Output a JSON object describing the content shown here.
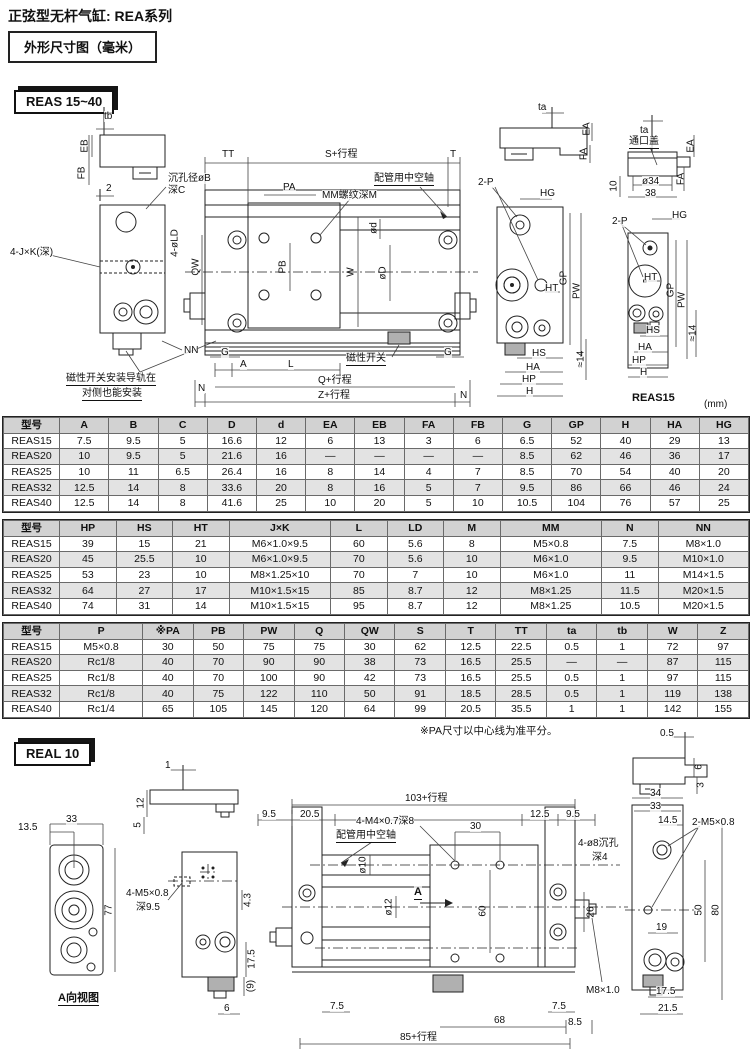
{
  "page": {
    "title": "正弦型无杆气缸: REA系列",
    "subtitle": "外形尺寸图（毫米）",
    "unit_note": "(mm)"
  },
  "sections": {
    "reas_badge": "REAS 15~40",
    "real_badge": "REAL 10"
  },
  "notes": {
    "pa_note": "※PA尺寸以中心线为准平分。"
  },
  "reas_labels": [
    {
      "t": "tb",
      "x": 104,
      "y": 16
    },
    {
      "t": "EB",
      "x": 85,
      "y": 51,
      "r": 1
    },
    {
      "t": "FB",
      "x": 82,
      "y": 78,
      "r": 1
    },
    {
      "t": "2",
      "x": 106,
      "y": 88
    },
    {
      "t": "沉孔径øB",
      "x": 168,
      "y": 78
    },
    {
      "t": "深C",
      "x": 168,
      "y": 90
    },
    {
      "t": "4-J×K(深)",
      "x": 10,
      "y": 152
    },
    {
      "t": "4-øLD",
      "x": 175,
      "y": 148,
      "r": 1
    },
    {
      "t": "QW",
      "x": 196,
      "y": 172,
      "r": 1
    },
    {
      "t": "NN",
      "x": 184,
      "y": 250
    },
    {
      "t": "磁性开关安装导轨在",
      "x": 66,
      "y": 278,
      "u": 1
    },
    {
      "t": "对侧也能安装",
      "x": 82,
      "y": 293,
      "u": 1
    },
    {
      "t": "TT",
      "x": 222,
      "y": 54
    },
    {
      "t": "S+行程",
      "x": 325,
      "y": 54
    },
    {
      "t": "T",
      "x": 450,
      "y": 54
    },
    {
      "t": "PA",
      "x": 283,
      "y": 87
    },
    {
      "t": "MM螺纹深M",
      "x": 322,
      "y": 95
    },
    {
      "t": "配管用中空轴",
      "x": 374,
      "y": 78,
      "u": 1
    },
    {
      "t": "ød",
      "x": 374,
      "y": 133,
      "r": 1
    },
    {
      "t": "øD",
      "x": 383,
      "y": 178,
      "r": 1
    },
    {
      "t": "W",
      "x": 351,
      "y": 177,
      "r": 1
    },
    {
      "t": "PB",
      "x": 283,
      "y": 172,
      "r": 1
    },
    {
      "t": "G",
      "x": 221,
      "y": 252
    },
    {
      "t": "A",
      "x": 240,
      "y": 264
    },
    {
      "t": "L",
      "x": 288,
      "y": 264
    },
    {
      "t": "磁性开关",
      "x": 346,
      "y": 258,
      "u": 1
    },
    {
      "t": "G",
      "x": 444,
      "y": 252
    },
    {
      "t": "Q+行程",
      "x": 318,
      "y": 280
    },
    {
      "t": "Z+行程",
      "x": 318,
      "y": 295
    },
    {
      "t": "N",
      "x": 198,
      "y": 288
    },
    {
      "t": "N",
      "x": 460,
      "y": 295
    },
    {
      "t": "ta",
      "x": 538,
      "y": 7
    },
    {
      "t": "EA",
      "x": 587,
      "y": 34,
      "r": 1
    },
    {
      "t": "FA",
      "x": 584,
      "y": 59,
      "r": 1
    },
    {
      "t": "ta",
      "x": 640,
      "y": 30
    },
    {
      "t": "通口盖",
      "x": 629,
      "y": 41,
      "u": 1
    },
    {
      "t": "ø34",
      "x": 642,
      "y": 81
    },
    {
      "t": "38",
      "x": 645,
      "y": 93
    },
    {
      "t": "10",
      "x": 614,
      "y": 91,
      "r": 1
    },
    {
      "t": "EA",
      "x": 691,
      "y": 51,
      "r": 1
    },
    {
      "t": "FA",
      "x": 681,
      "y": 84,
      "r": 1
    },
    {
      "t": "2-P",
      "x": 478,
      "y": 82
    },
    {
      "t": "HG",
      "x": 540,
      "y": 93
    },
    {
      "t": "GP",
      "x": 564,
      "y": 183,
      "r": 1
    },
    {
      "t": "PW",
      "x": 577,
      "y": 196,
      "r": 1
    },
    {
      "t": "HT",
      "x": 545,
      "y": 188
    },
    {
      "t": "HS",
      "x": 532,
      "y": 253
    },
    {
      "t": "HA",
      "x": 526,
      "y": 267
    },
    {
      "t": "HP",
      "x": 522,
      "y": 279
    },
    {
      "t": "H",
      "x": 526,
      "y": 291
    },
    {
      "t": "≈14",
      "x": 581,
      "y": 264,
      "r": 1
    },
    {
      "t": "2-P",
      "x": 612,
      "y": 121
    },
    {
      "t": "HG",
      "x": 672,
      "y": 115
    },
    {
      "t": "GP",
      "x": 671,
      "y": 195,
      "r": 1
    },
    {
      "t": "PW",
      "x": 682,
      "y": 205,
      "r": 1
    },
    {
      "t": "HT",
      "x": 644,
      "y": 177
    },
    {
      "t": "HS",
      "x": 646,
      "y": 230
    },
    {
      "t": "HA",
      "x": 638,
      "y": 247
    },
    {
      "t": "HP",
      "x": 632,
      "y": 260
    },
    {
      "t": "H",
      "x": 640,
      "y": 272
    },
    {
      "t": "≈14",
      "x": 693,
      "y": 238,
      "r": 1
    },
    {
      "t": "REAS15",
      "x": 632,
      "y": 297,
      "b": 1
    }
  ],
  "real_labels": [
    {
      "t": "0.5",
      "x": 660,
      "y": 8
    },
    {
      "t": "6",
      "x": 699,
      "y": 47,
      "r": 1
    },
    {
      "t": "3",
      "x": 701,
      "y": 65,
      "r": 1
    },
    {
      "t": "13.5",
      "x": 18,
      "y": 102
    },
    {
      "t": "33",
      "x": 66,
      "y": 94
    },
    {
      "t": "77",
      "x": 109,
      "y": 190,
      "r": 1
    },
    {
      "t": "A向视图",
      "x": 58,
      "y": 272,
      "u": 1,
      "b": 1
    },
    {
      "t": "1",
      "x": 165,
      "y": 40
    },
    {
      "t": "12",
      "x": 141,
      "y": 83,
      "r": 1
    },
    {
      "t": "5",
      "x": 138,
      "y": 105,
      "r": 1
    },
    {
      "t": "4-M5×0.8",
      "x": 126,
      "y": 168
    },
    {
      "t": "深9.5",
      "x": 136,
      "y": 182
    },
    {
      "t": "4.3",
      "x": 248,
      "y": 180,
      "r": 1
    },
    {
      "t": "17.5",
      "x": 252,
      "y": 239,
      "r": 1
    },
    {
      "t": "(9)",
      "x": 251,
      "y": 266,
      "r": 1
    },
    {
      "t": "6",
      "x": 224,
      "y": 283
    },
    {
      "t": "103+行程",
      "x": 405,
      "y": 73
    },
    {
      "t": "9.5",
      "x": 262,
      "y": 89
    },
    {
      "t": "20.5",
      "x": 300,
      "y": 89
    },
    {
      "t": "12.5",
      "x": 530,
      "y": 89
    },
    {
      "t": "9.5",
      "x": 566,
      "y": 89
    },
    {
      "t": "4-M4×0.7深8",
      "x": 356,
      "y": 96
    },
    {
      "t": "30",
      "x": 470,
      "y": 101
    },
    {
      "t": "配管用中空轴",
      "x": 336,
      "y": 110,
      "u": 1
    },
    {
      "t": "ø10",
      "x": 363,
      "y": 145,
      "r": 1
    },
    {
      "t": "ø12",
      "x": 389,
      "y": 187,
      "r": 1
    },
    {
      "t": "A",
      "x": 414,
      "y": 166,
      "u": 1,
      "b": 1
    },
    {
      "t": "60",
      "x": 483,
      "y": 191,
      "r": 1
    },
    {
      "t": "26",
      "x": 591,
      "y": 192,
      "r": 1
    },
    {
      "t": "4-ø8沉孔",
      "x": 578,
      "y": 118
    },
    {
      "t": "深4",
      "x": 592,
      "y": 132
    },
    {
      "t": "34",
      "x": 650,
      "y": 68
    },
    {
      "t": "33",
      "x": 650,
      "y": 81
    },
    {
      "t": "14.5",
      "x": 658,
      "y": 95
    },
    {
      "t": "2-M5×0.8",
      "x": 692,
      "y": 97
    },
    {
      "t": "19",
      "x": 656,
      "y": 202
    },
    {
      "t": "50",
      "x": 699,
      "y": 190,
      "r": 1
    },
    {
      "t": "80",
      "x": 716,
      "y": 190,
      "r": 1
    },
    {
      "t": "M8×1.0",
      "x": 586,
      "y": 265
    },
    {
      "t": "17.5",
      "x": 656,
      "y": 266
    },
    {
      "t": "21.5",
      "x": 658,
      "y": 283
    },
    {
      "t": "7.5",
      "x": 330,
      "y": 281
    },
    {
      "t": "68",
      "x": 494,
      "y": 295
    },
    {
      "t": "7.5",
      "x": 552,
      "y": 281
    },
    {
      "t": "8.5",
      "x": 568,
      "y": 297
    },
    {
      "t": "85+行程",
      "x": 400,
      "y": 312
    }
  ],
  "tables": [
    {
      "headers": [
        "型号",
        "A",
        "B",
        "C",
        "D",
        "d",
        "EA",
        "EB",
        "FA",
        "FB",
        "G",
        "GP",
        "H",
        "HA",
        "HG"
      ],
      "rows": [
        [
          "REAS15",
          "7.5",
          "9.5",
          "5",
          "16.6",
          "12",
          "6",
          "13",
          "3",
          "6",
          "6.5",
          "52",
          "40",
          "29",
          "13"
        ],
        [
          "REAS20",
          "10",
          "9.5",
          "5",
          "21.6",
          "16",
          "—",
          "—",
          "—",
          "—",
          "8.5",
          "62",
          "46",
          "36",
          "17"
        ],
        [
          "REAS25",
          "10",
          "11",
          "6.5",
          "26.4",
          "16",
          "8",
          "14",
          "4",
          "7",
          "8.5",
          "70",
          "54",
          "40",
          "20"
        ],
        [
          "REAS32",
          "12.5",
          "14",
          "8",
          "33.6",
          "20",
          "8",
          "16",
          "5",
          "7",
          "9.5",
          "86",
          "66",
          "46",
          "24"
        ],
        [
          "REAS40",
          "12.5",
          "14",
          "8",
          "41.6",
          "25",
          "10",
          "20",
          "5",
          "10",
          "10.5",
          "104",
          "76",
          "57",
          "25"
        ]
      ]
    },
    {
      "headers": [
        "型号",
        "HP",
        "HS",
        "HT",
        "J×K",
        "L",
        "LD",
        "M",
        "MM",
        "N",
        "NN"
      ],
      "rows": [
        [
          "REAS15",
          "39",
          "15",
          "21",
          "M6×1.0×9.5",
          "60",
          "5.6",
          "8",
          "M5×0.8",
          "7.5",
          "M8×1.0"
        ],
        [
          "REAS20",
          "45",
          "25.5",
          "10",
          "M6×1.0×9.5",
          "70",
          "5.6",
          "10",
          "M6×1.0",
          "9.5",
          "M10×1.0"
        ],
        [
          "REAS25",
          "53",
          "23",
          "10",
          "M8×1.25×10",
          "70",
          "7",
          "10",
          "M6×1.0",
          "11",
          "M14×1.5"
        ],
        [
          "REAS32",
          "64",
          "27",
          "17",
          "M10×1.5×15",
          "85",
          "8.7",
          "12",
          "M8×1.25",
          "11.5",
          "M20×1.5"
        ],
        [
          "REAS40",
          "74",
          "31",
          "14",
          "M10×1.5×15",
          "95",
          "8.7",
          "12",
          "M8×1.25",
          "10.5",
          "M20×1.5"
        ]
      ]
    },
    {
      "headers": [
        "型号",
        "P",
        "※PA",
        "PB",
        "PW",
        "Q",
        "QW",
        "S",
        "T",
        "TT",
        "ta",
        "tb",
        "W",
        "Z"
      ],
      "rows": [
        [
          "REAS15",
          "M5×0.8",
          "30",
          "50",
          "75",
          "75",
          "30",
          "62",
          "12.5",
          "22.5",
          "0.5",
          "1",
          "72",
          "97"
        ],
        [
          "REAS20",
          "Rc1/8",
          "40",
          "70",
          "90",
          "90",
          "38",
          "73",
          "16.5",
          "25.5",
          "—",
          "—",
          "87",
          "115"
        ],
        [
          "REAS25",
          "Rc1/8",
          "40",
          "70",
          "100",
          "90",
          "42",
          "73",
          "16.5",
          "25.5",
          "0.5",
          "1",
          "97",
          "115"
        ],
        [
          "REAS32",
          "Rc1/8",
          "40",
          "75",
          "122",
          "110",
          "50",
          "91",
          "18.5",
          "28.5",
          "0.5",
          "1",
          "119",
          "138"
        ],
        [
          "REAS40",
          "Rc1/4",
          "65",
          "105",
          "145",
          "120",
          "64",
          "99",
          "20.5",
          "35.5",
          "1",
          "1",
          "142",
          "155"
        ]
      ]
    }
  ]
}
